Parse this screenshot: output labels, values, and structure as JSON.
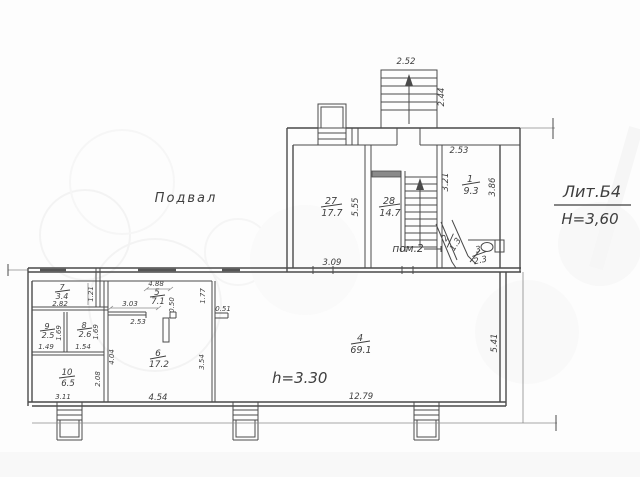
{
  "labels": {
    "floor": "Подвал",
    "liter": "Лит.Б4",
    "building_height": "Н=3,60",
    "ceiling_height": "h=3.30",
    "pom2": "пом.2"
  },
  "rooms": {
    "r27": {
      "num": "27",
      "area": "17.7"
    },
    "r28": {
      "num": "28",
      "area": "14.7"
    },
    "r1": {
      "num": "1",
      "area": "9.3"
    },
    "r2": {
      "num": "2",
      "area": "1.3"
    },
    "r3": {
      "num": "3",
      "area": "2.3"
    },
    "r7": {
      "num": "7",
      "area": "3.4"
    },
    "r9": {
      "num": "9",
      "area": "2.5"
    },
    "r8": {
      "num": "8",
      "area": "2.6"
    },
    "r10": {
      "num": "10",
      "area": "6.5"
    },
    "r5": {
      "num": "5",
      "area": "7.1"
    },
    "r6": {
      "num": "6",
      "area": "17.2"
    },
    "r4": {
      "num": "4",
      "area": "69.1"
    }
  },
  "dims": {
    "stair_w": "2.52",
    "stair_d": "2.44",
    "r27_h": "5.55",
    "r27_w": "3.09",
    "r1_w": "2.53",
    "r1_hl": "3.21",
    "r1_hr": "3.86",
    "r7_w": "2.82",
    "r7_h": "1.21",
    "r9_w": "1.49",
    "r9_h": "1.69",
    "r8_w": "1.54",
    "r8_h": "1.69",
    "r10_w": "3.11",
    "r10_h": "2.08",
    "corr": "4.04",
    "r5_w": "4.88",
    "r5_s1": "3.03",
    "r5_s2": "2.53",
    "duct": "0.50",
    "gap": "1.77",
    "stub": "0.51",
    "r6_hr": "3.54",
    "r6_w": "4.54",
    "r4_w": "12.79",
    "r4_h": "5.41"
  },
  "colors": {
    "line": "#4a4a4a",
    "watermark": "#ededed",
    "faded_text": "#ababab"
  }
}
